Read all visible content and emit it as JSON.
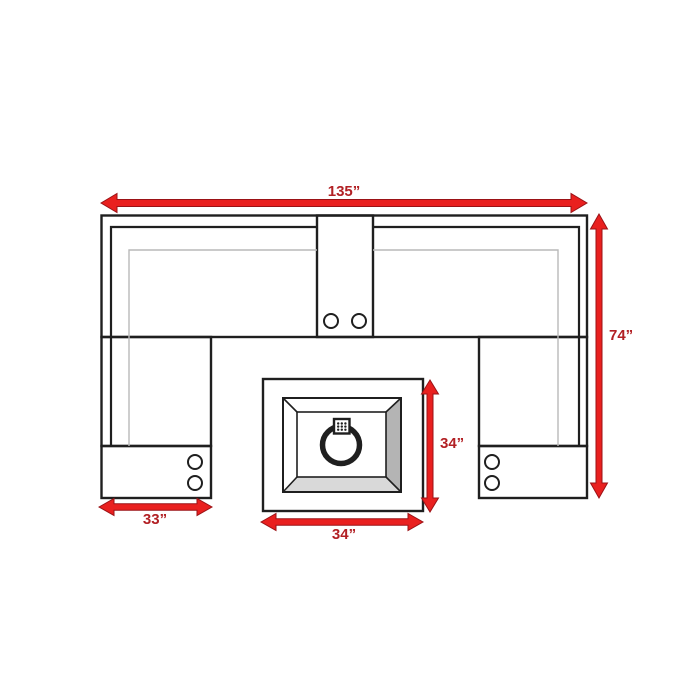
{
  "diagram": {
    "name": "sectional-sofa-with-fire-table-dimension-diagram",
    "dimension_labels": {
      "overall_width": "135”",
      "overall_depth": "74”",
      "left_console_width": "33”",
      "fire_table_width": "34”",
      "fire_table_depth": "34”"
    },
    "icons": [
      "cupholder-icon",
      "fire-ring-icon",
      "burner-icon"
    ],
    "colors": {
      "arrow_red": "#e9201f",
      "label_red": "#b22024",
      "line_black": "#1f1f1f",
      "line_gray": "#b9b9b9",
      "bevel_side_gray": "#b4b4b4",
      "bevel_bottom_gray": "#d9d9d9",
      "background": "#ffffff"
    }
  }
}
